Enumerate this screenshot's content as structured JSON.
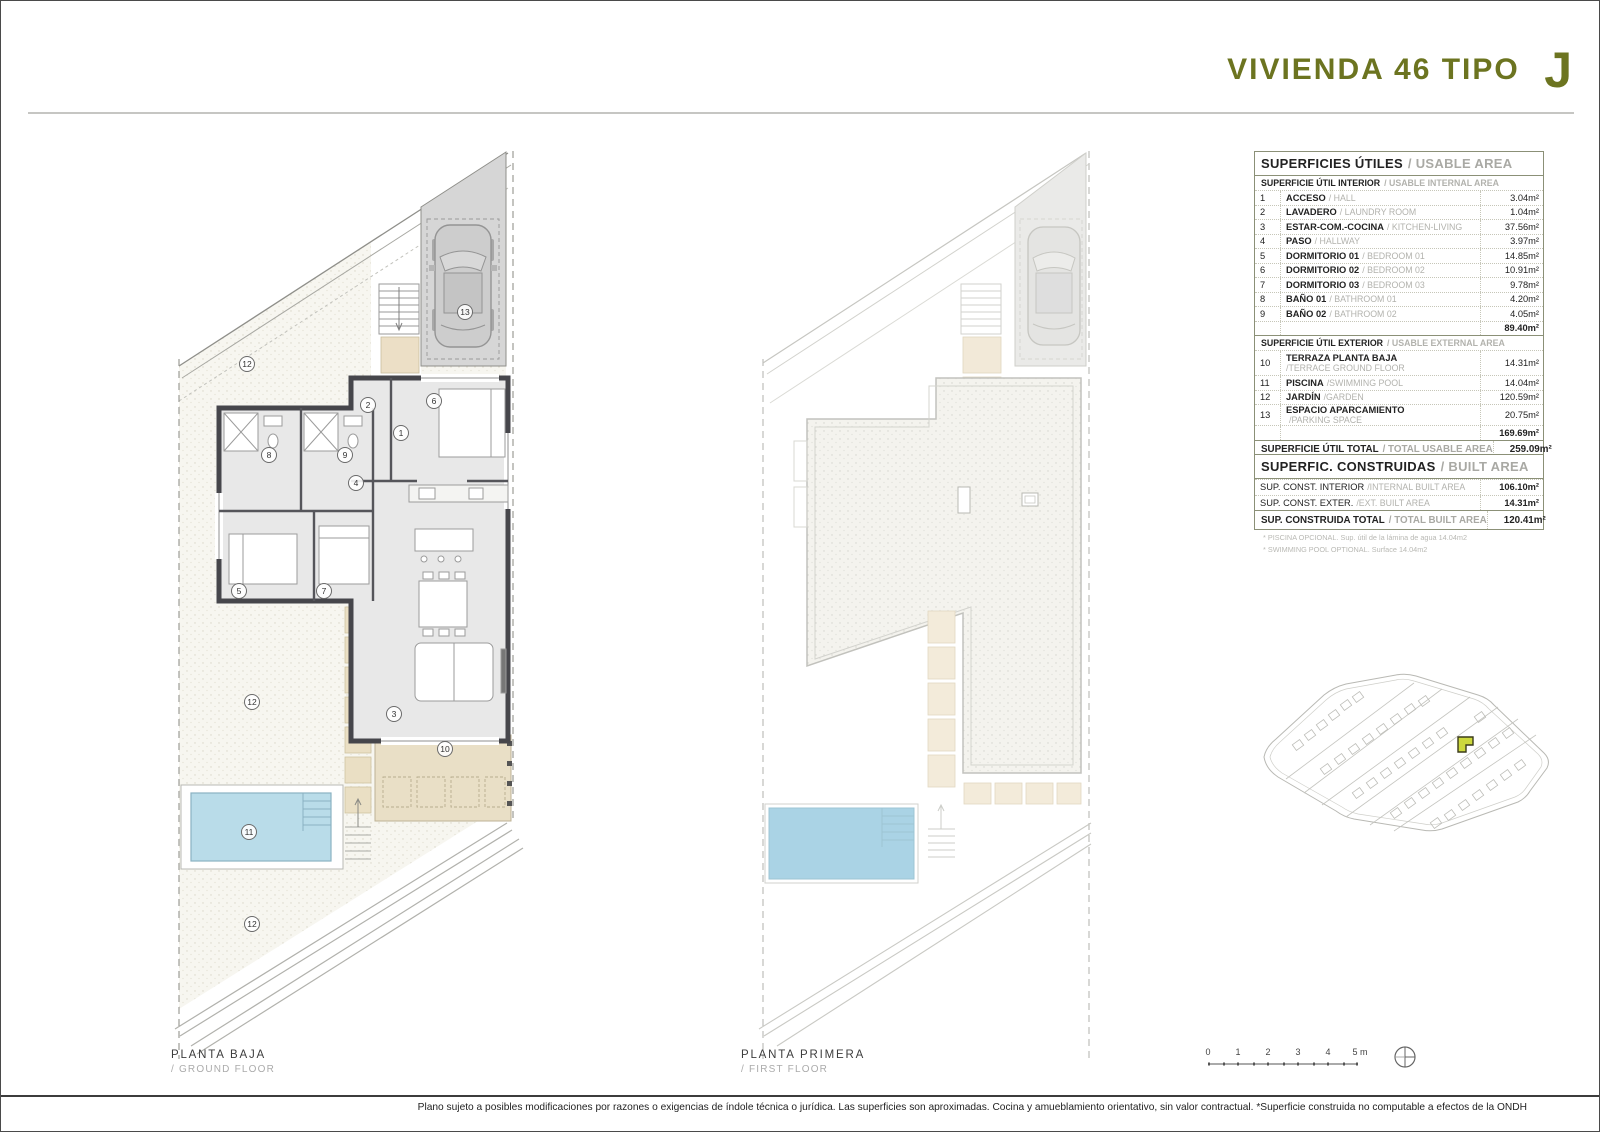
{
  "header": {
    "title": "VIVIENDA 46 TIPO",
    "type_letter": "J"
  },
  "usable": {
    "title_es": "SUPERFICIES ÚTILES",
    "title_en": "/ USABLE AREA",
    "interior_header_es": "SUPERFICIE ÚTIL INTERIOR",
    "interior_header_en": "/ USABLE INTERNAL AREA",
    "interior_rows": [
      {
        "num": "1",
        "es": "ACCESO",
        "en": "/ HALL",
        "value": "3.04m²"
      },
      {
        "num": "2",
        "es": "LAVADERO",
        "en": "/ LAUNDRY ROOM",
        "value": "1.04m²"
      },
      {
        "num": "3",
        "es": "ESTAR-COM.-COCINA",
        "en": "/ KITCHEN-LIVING",
        "value": "37.56m²"
      },
      {
        "num": "4",
        "es": "PASO",
        "en": "/ HALLWAY",
        "value": "3.97m²"
      },
      {
        "num": "5",
        "es": "DORMITORIO 01",
        "en": "/ BEDROOM 01",
        "value": "14.85m²"
      },
      {
        "num": "6",
        "es": "DORMITORIO 02",
        "en": "/ BEDROOM 02",
        "value": "10.91m²"
      },
      {
        "num": "7",
        "es": "DORMITORIO 03",
        "en": "/ BEDROOM 03",
        "value": "9.78m²"
      },
      {
        "num": "8",
        "es": "BAÑO 01",
        "en": "/ BATHROOM 01",
        "value": "4.20m²"
      },
      {
        "num": "9",
        "es": "BAÑO 02",
        "en": "/ BATHROOM 02",
        "value": "4.05m²"
      }
    ],
    "interior_subtotal": "89.40m²",
    "exterior_header_es": "SUPERFICIE ÚTIL EXTERIOR",
    "exterior_header_en": "/ USABLE EXTERNAL AREA",
    "exterior_rows": [
      {
        "num": "10",
        "es": "TERRAZA PLANTA BAJA",
        "en": "/TERRACE GROUND FLOOR",
        "value": "14.31m²"
      },
      {
        "num": "11",
        "es": "PISCINA",
        "en": "/SWIMMING POOL",
        "value": "14.04m²"
      },
      {
        "num": "12",
        "es": "JARDÍN",
        "en": "/GARDEN",
        "value": "120.59m²"
      },
      {
        "num": "13",
        "es": "ESPACIO APARCAMIENTO",
        "en": "/PARKING SPACE",
        "value": "20.75m²"
      }
    ],
    "exterior_subtotal": "169.69m²",
    "total_es": "SUPERFICIE ÚTIL TOTAL",
    "total_en": "/ TOTAL USABLE AREA",
    "total_value": "259.09m²"
  },
  "built": {
    "title_es": "SUPERFIC. CONSTRUIDAS",
    "title_en": "/ BUILT AREA",
    "rows": [
      {
        "es": "SUP. CONST. INTERIOR",
        "en": "/INTERNAL BUILT AREA",
        "value": "106.10m²"
      },
      {
        "es": "SUP. CONST. EXTER.",
        "en": "/EXT. BUILT AREA",
        "value": "14.31m²"
      }
    ],
    "total_es": "SUP. CONSTRUIDA TOTAL",
    "total_en": "/ TOTAL BUILT AREA",
    "total_value": "120.41m²"
  },
  "footnotes": [
    "* PISCINA OPCIONAL. Sup. útil de la lámina de agua 14.04m2",
    "* SWIMMING POOL OPTIONAL. Surface 14.04m2"
  ],
  "captions": {
    "gf_es": "PLANTA BAJA",
    "gf_en": "/ GROUND FLOOR",
    "ff_es": "PLANTA PRIMERA",
    "ff_en": "/ FIRST FLOOR"
  },
  "ground_floor_labels": {
    "n1": "1",
    "n2": "2",
    "n3": "3",
    "n4": "4",
    "n5": "5",
    "n6": "6",
    "n7": "7",
    "n8": "8",
    "n9": "9",
    "n10": "10",
    "n11": "11",
    "n13": "13",
    "n12a": "12",
    "n12b": "12",
    "n12c": "12"
  },
  "scale": {
    "ticks": [
      "0",
      "1",
      "2",
      "3",
      "4",
      "5 m"
    ]
  },
  "footer": {
    "disclaimer": "Plano sujeto a posibles modificaciones por razones o exigencias de índole técnica o jurídica. Las superficies son aproximadas. Cocina y amueblamiento orientativo, sin valor contractual. *Superficie construida no computable a efectos de la ONDH"
  },
  "colors": {
    "accent_olive": "#6c7420",
    "table_border": "#8b9077",
    "pool_water": "#b9dce9",
    "terrace_beige": "#e9dfc6",
    "garage_gray": "#d6d6d6",
    "site_highlight": "#ccd83d"
  }
}
